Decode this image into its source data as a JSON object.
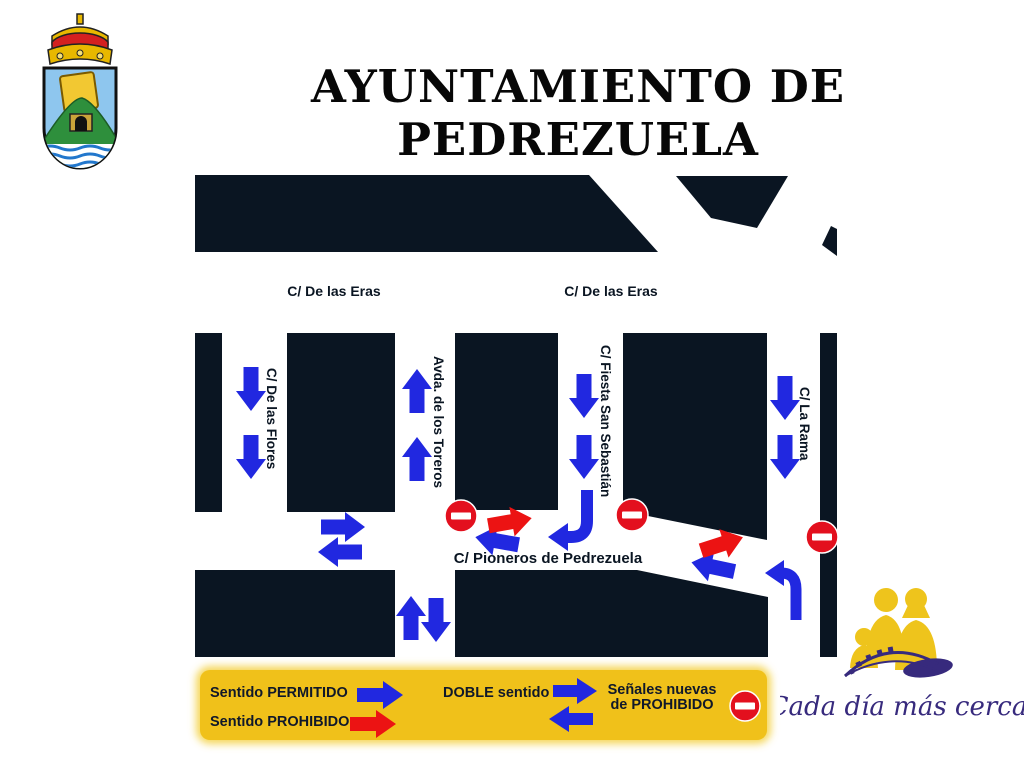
{
  "header": {
    "title": "AYUNTAMIENTO DE PEDREZUELA",
    "crest_name": "escudo-de-pedrezuela"
  },
  "map": {
    "street_labels": {
      "eras_left": "C/ De las Eras",
      "eras_right": "C/ De las Eras",
      "flores": "C/ De las Flores",
      "toreros": "Avda. de los Toreros",
      "fiesta_san_sebastian": "C/ Fiesta San Sebastián",
      "la_rama": "C/ La Rama",
      "pioneros": "C/ Pioneros de Pedrezuela"
    },
    "signals": {
      "one_way_arrows": [
        {
          "street": "C/ De las Flores",
          "direction": "down",
          "count": 2
        },
        {
          "street": "Avda. de los Toreros",
          "direction": "up",
          "count": 2
        },
        {
          "street": "C/ Fiesta San Sebastián",
          "direction": "down",
          "count": 2
        },
        {
          "street": "C/ La Rama",
          "direction": "down",
          "count": 2
        }
      ],
      "double_direction_streets": [
        "C/ Pioneros de Pedrezuela",
        "Avda. de los Toreros"
      ],
      "prohibited_direction_arrows": 3,
      "no_entry_signs": 3,
      "turn_arrows": 2
    }
  },
  "legend": {
    "permitted": "Sentido PERMITIDO",
    "prohibited": "Sentido PROHIBIDO",
    "double": "DOBLE sentido",
    "new_signs_line1": "Señales nuevas",
    "new_signs_line2": "de PROHIBIDO"
  },
  "branding": {
    "slogan": "Cada día más cerca"
  },
  "colors": {
    "building_block": "#0a1522",
    "arrow_permitted": "#2128e0",
    "arrow_prohibited": "#ec1313",
    "no_entry_sign": "#e3101e",
    "legend_background": "#f0c11a",
    "slogan_text": "#372a7d",
    "street_label": "#0a1522"
  }
}
